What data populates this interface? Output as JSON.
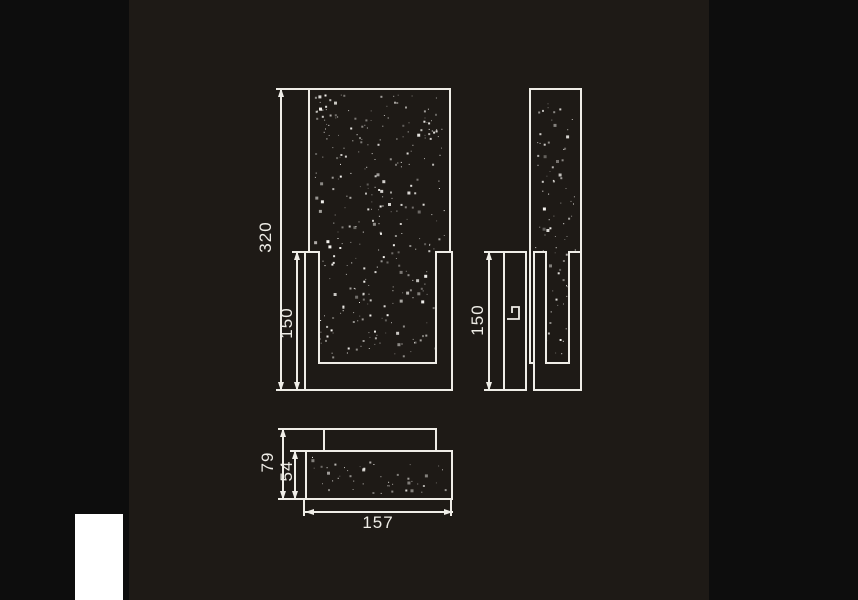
{
  "dimensions": {
    "front_total_height": "320",
    "front_bracket_height": "150",
    "side_bracket_height": "150",
    "bottom_total_depth": "79",
    "bottom_crystal_depth": "54",
    "bottom_width": "157"
  },
  "colors": {
    "canvas": "#0d0d0d",
    "panel": "#1e1a16",
    "line": "#efede7",
    "patch": "#ffffff"
  }
}
